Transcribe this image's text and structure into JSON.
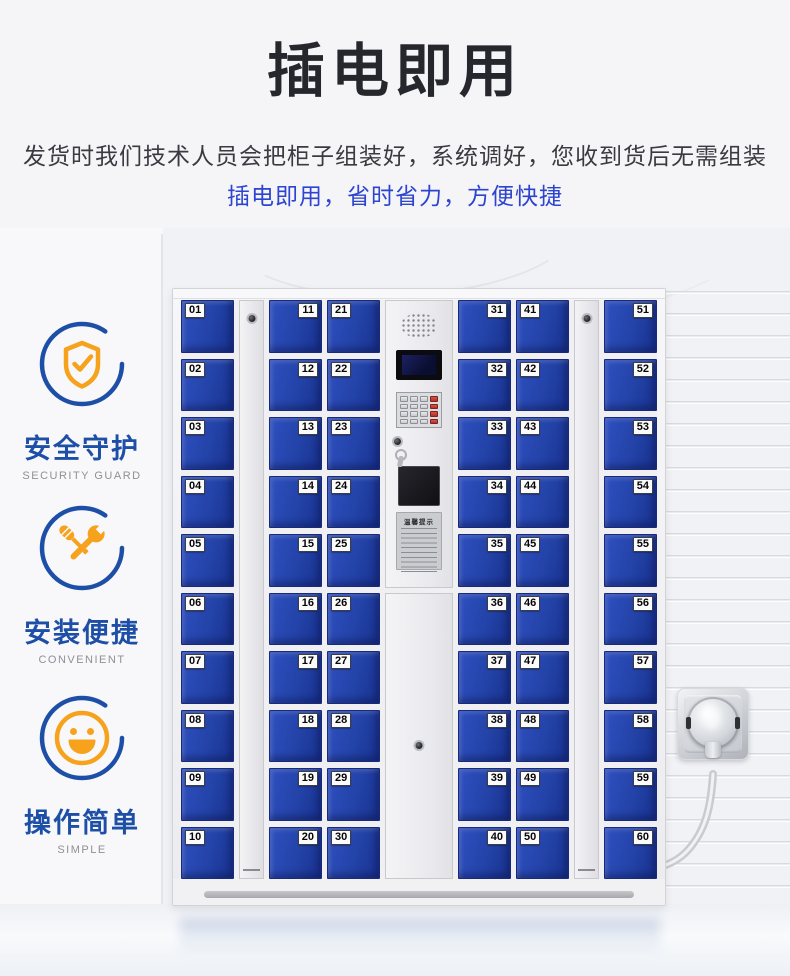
{
  "header": {
    "title": "插电即用",
    "desc_line1": "发货时我们技术人员会把柜子组装好，系统调好，您收到货后无需组装",
    "desc_line2": "插电即用，省时省力，方便快捷"
  },
  "features": [
    {
      "icon": "shield-check-icon",
      "label": "安全守护",
      "caption": "SECURITY GUARD"
    },
    {
      "icon": "tools-icon",
      "label": "安装便捷",
      "caption": "CONVENIENT"
    },
    {
      "icon": "smiley-icon",
      "label": "操作简单",
      "caption": "SIMPLE"
    }
  ],
  "locker": {
    "columns": [
      {
        "type": "doors",
        "label_side": "left",
        "numbers": [
          "01",
          "02",
          "03",
          "04",
          "05",
          "06",
          "07",
          "08",
          "09",
          "10"
        ]
      },
      {
        "type": "master"
      },
      {
        "type": "doors",
        "label_side": "right",
        "numbers": [
          "11",
          "12",
          "13",
          "14",
          "15",
          "16",
          "17",
          "18",
          "19",
          "20"
        ]
      },
      {
        "type": "doors",
        "label_side": "left",
        "numbers": [
          "21",
          "22",
          "23",
          "24",
          "25",
          "26",
          "27",
          "28",
          "29",
          "30"
        ]
      },
      {
        "type": "console"
      },
      {
        "type": "doors",
        "label_side": "right",
        "numbers": [
          "31",
          "32",
          "33",
          "34",
          "35",
          "36",
          "37",
          "38",
          "39",
          "40"
        ]
      },
      {
        "type": "doors",
        "label_side": "left",
        "numbers": [
          "41",
          "42",
          "43",
          "44",
          "45",
          "46",
          "47",
          "48",
          "49",
          "50"
        ]
      },
      {
        "type": "master"
      },
      {
        "type": "doors",
        "label_side": "right",
        "numbers": [
          "51",
          "52",
          "53",
          "54",
          "55",
          "56",
          "57",
          "58",
          "59",
          "60"
        ]
      }
    ],
    "console": {
      "notice_title": "温馨提示"
    }
  },
  "colors": {
    "door_blue": "#2343a8",
    "accent_blue": "#1d4fa6",
    "accent_orange": "#f6a21c",
    "desc_blue": "#2c44cf",
    "keypad_red": "#b03028"
  }
}
